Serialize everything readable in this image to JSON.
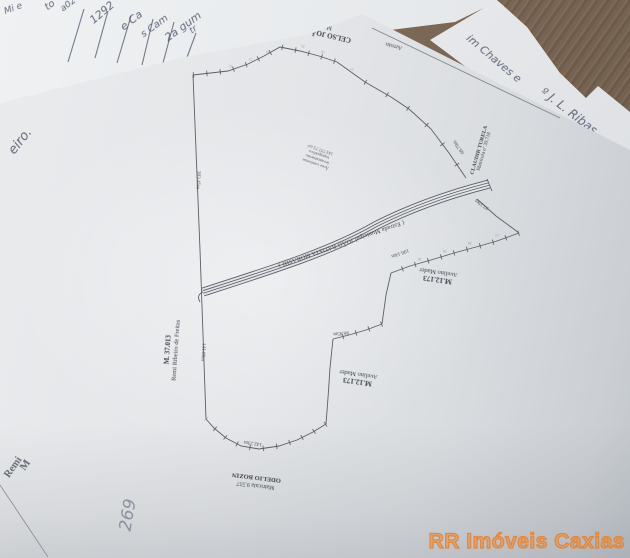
{
  "watermark": {
    "text": "RR Imóveis Caxias",
    "color": "#e8873b"
  },
  "plan": {
    "top_neighbor": {
      "l1": "CELSO JOÃO SPERANDIO",
      "l2": "Matrícula nº 40.629"
    },
    "strip_label": "Arroio",
    "right_neighbor": {
      "l1": "CLAUDIR TURELA",
      "l2": "Matrícula nº 39.718"
    },
    "mader1": {
      "l1": "M.12.173",
      "l2": "Avelino Mader"
    },
    "mader2": {
      "l1": "M.12.173",
      "l2": "Avelino Mader"
    },
    "left_neighbor": {
      "l1": "M. 37.013",
      "l2": "Remi Ribeiro de Freitas"
    },
    "bottom_neighbor": {
      "l1": "Matrícula 9.557",
      "l2": "ODELIO BOZIN"
    },
    "road_label": "( Estrada Municipal JOÃO BATISTA MORASHI )",
    "area_note": {
      "l1": "Área conforme",
      "l2": "levantamento",
      "l3": "topográfico",
      "l4": "143.757,72 m²"
    },
    "dims": [
      "303.45m",
      "141.80m",
      "142.23m",
      "86.85m",
      "100.14m",
      "68.70m",
      "97.59m"
    ],
    "ticknums": [
      "12",
      "13",
      "14",
      "15",
      "16",
      "17",
      "18",
      "19",
      "20",
      "21"
    ]
  },
  "handwriting": {
    "topleft": [
      "Mi e",
      "to",
      "a02",
      "1292",
      "e Ca",
      "s Cam",
      "2a gum",
      "tr"
    ],
    "right": [
      "im Chaves e",
      "º J. L. Ribas"
    ],
    "left_edge": "eiro.",
    "bottom": {
      "remi": "Remi",
      "m": "M",
      "scribble": "269"
    }
  }
}
